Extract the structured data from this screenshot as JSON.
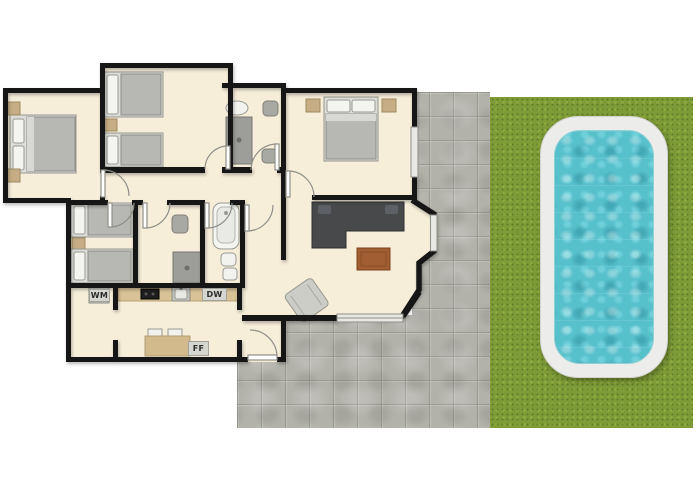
{
  "floorplan": {
    "type": "residential-floor-plan-with-pool",
    "labels": {
      "washing_machine": "WM",
      "dishwasher": "DW",
      "fridge_freezer": "FF"
    },
    "colors": {
      "background": "#ffffff",
      "wall": "#161616",
      "floor": "#f6eed9",
      "grass": "#7d9b37",
      "paver_stone": "#b2b1aa",
      "pool_frame": "#ececea",
      "pool_water": "#56c0cb",
      "kitchen_counter": "#d9c296",
      "wood_table": "#a05e32",
      "sofa": "#47494b",
      "furniture_tan": "#c6ad85",
      "furniture_gray": "#b7b7b3"
    }
  }
}
